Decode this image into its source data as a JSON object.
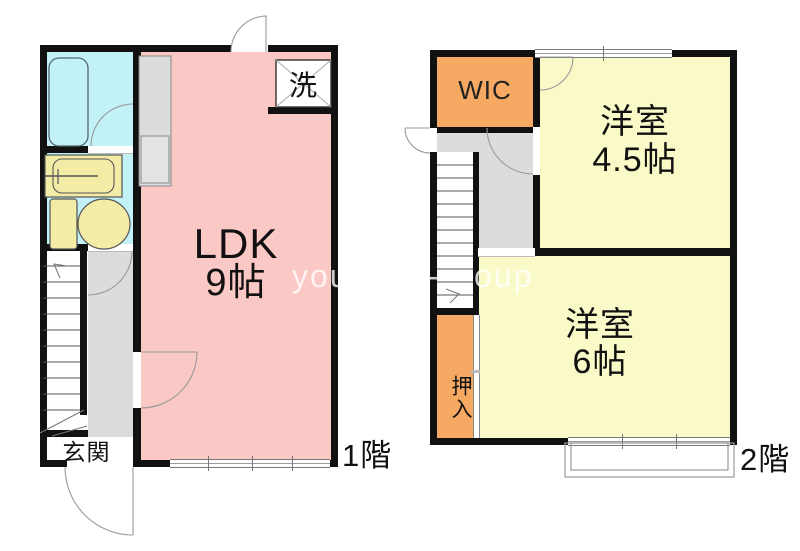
{
  "watermark": {
    "fragments": [
      "you",
      "-",
      "oup"
    ]
  },
  "colors": {
    "wall": "#111111",
    "ldk-pink": "#FAC8C5",
    "wet-cyan": "#C2F2F7",
    "room-yellow": "#FAFAC8",
    "closet-orange": "#F5A963",
    "hall-gray": "#DCDCDC",
    "kitchen-gray": "#DCDCDC",
    "fixture-yellow": "#F2ECA6"
  },
  "floor1": {
    "label": "1階",
    "rooms": {
      "ldk": {
        "name": "LDK",
        "size": "9帖"
      },
      "entrance": {
        "label": "玄関"
      },
      "laundry": {
        "label": "洗"
      }
    }
  },
  "floor2": {
    "label": "2階",
    "rooms": {
      "wic": {
        "label": "WIC"
      },
      "bedroom_45": {
        "name": "洋室",
        "size": "4.5帖"
      },
      "bedroom_6": {
        "name": "洋室",
        "size": "6帖"
      },
      "oshiire": {
        "label": "押入"
      }
    }
  }
}
